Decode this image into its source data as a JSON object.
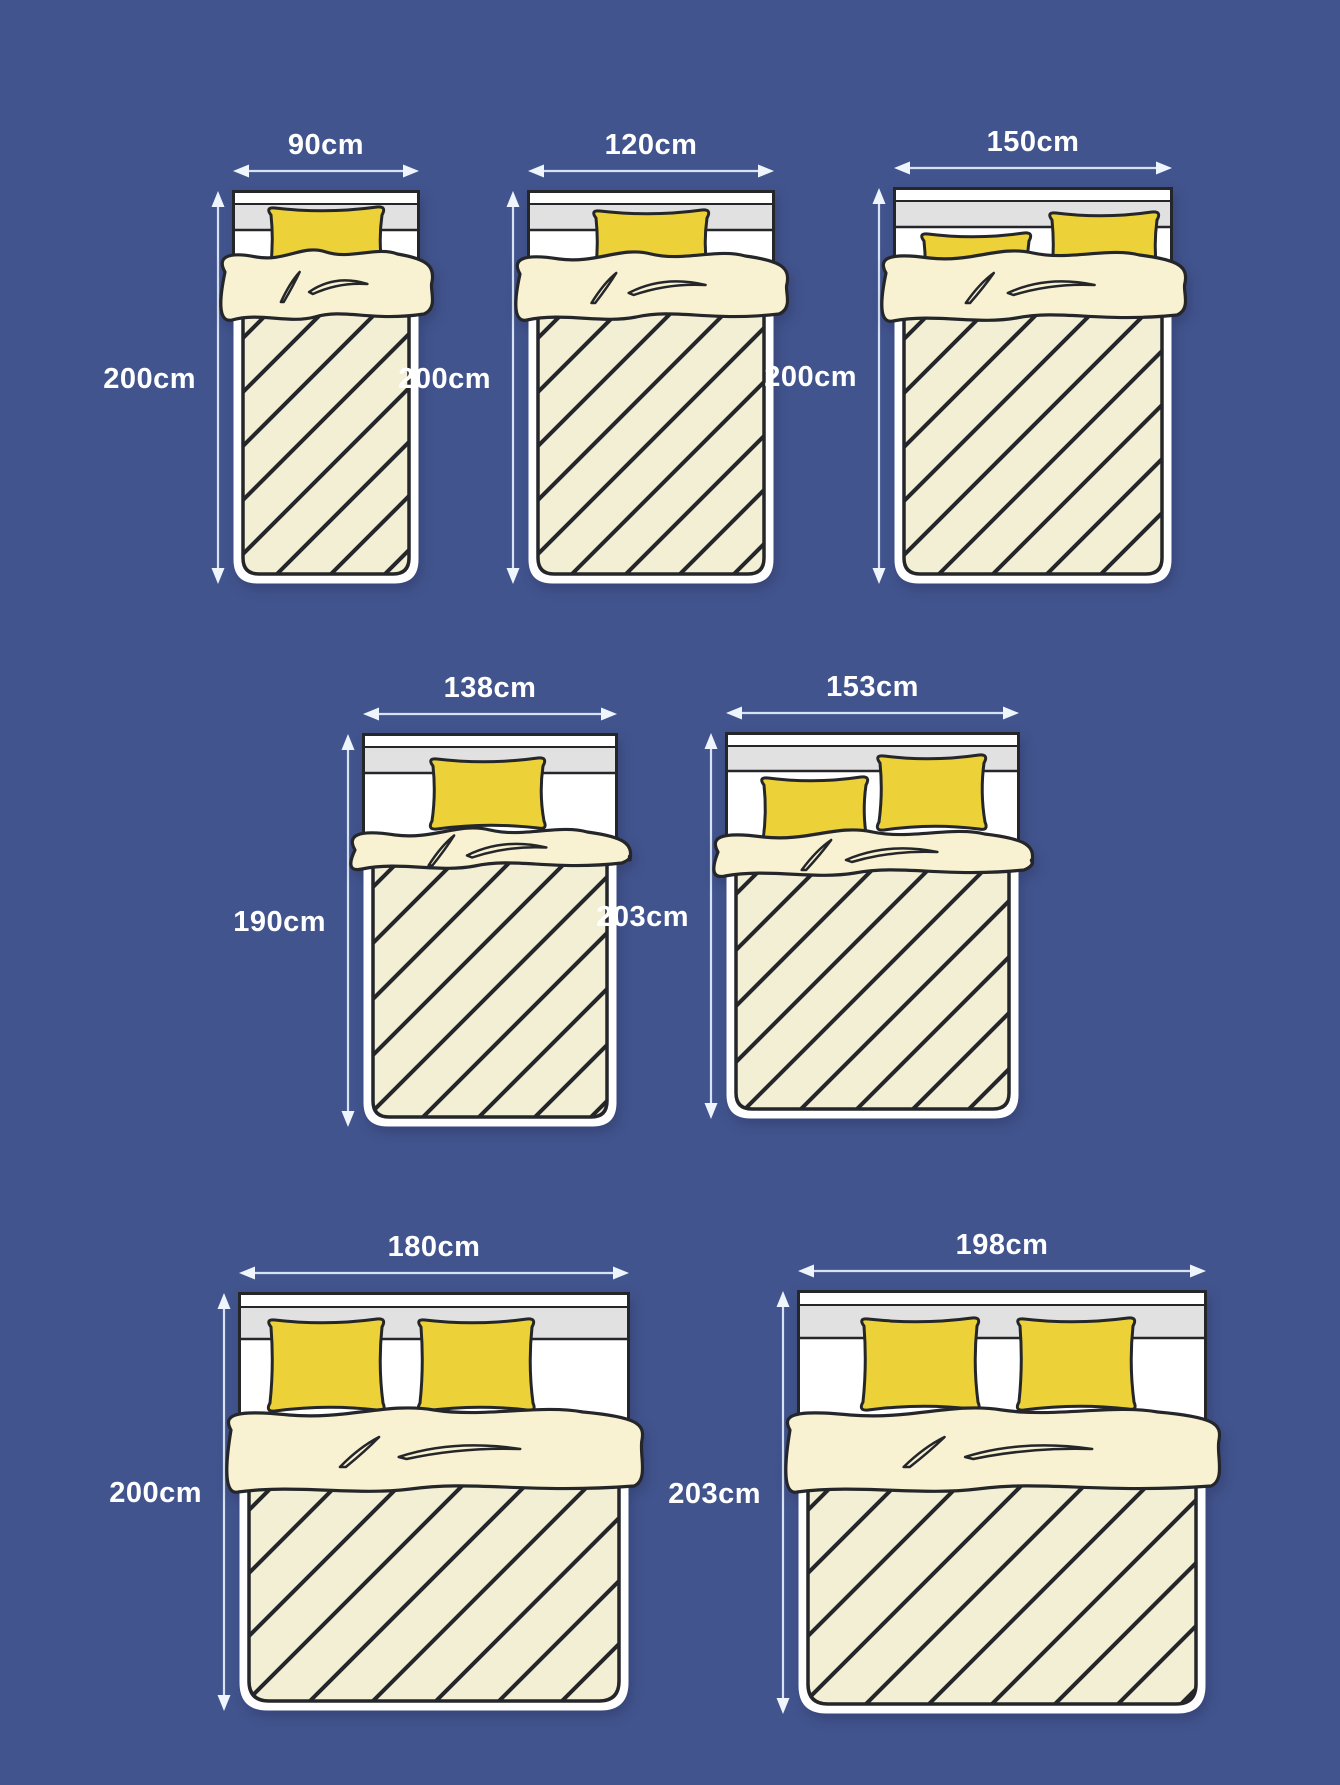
{
  "page": {
    "description": "Bed and mattress size comparison diagram",
    "unit": "cm"
  },
  "colors": {
    "background": "#42548e",
    "ink": "#24262a",
    "pillow": "#ecd138",
    "blanket": "#f8f2d2",
    "mattress": "#f3efd5",
    "headboard_gray": "#e1e1e1",
    "frame_white": "#ffffff",
    "arrow_line": "#d7e3f2",
    "arrow_head": "#eef5fc",
    "label_text": "#ffffff"
  },
  "rows": [
    {
      "beds": [
        {
          "width_label": "90cm",
          "height_label": "200cm",
          "width_cm": 90,
          "height_cm": 200,
          "pillows": 1
        },
        {
          "width_label": "120cm",
          "height_label": "200cm",
          "width_cm": 120,
          "height_cm": 200,
          "pillows": 1
        },
        {
          "width_label": "150cm",
          "height_label": "200cm",
          "width_cm": 150,
          "height_cm": 200,
          "pillows": 2
        }
      ]
    },
    {
      "beds": [
        {
          "width_label": "138cm",
          "height_label": "190cm",
          "width_cm": 138,
          "height_cm": 190,
          "pillows": 1
        },
        {
          "width_label": "153cm",
          "height_label": "203cm",
          "width_cm": 153,
          "height_cm": 203,
          "pillows": 2
        }
      ]
    },
    {
      "beds": [
        {
          "width_label": "180cm",
          "height_label": "200cm",
          "width_cm": 180,
          "height_cm": 200,
          "pillows": 2
        },
        {
          "width_label": "198cm",
          "height_label": "203cm",
          "width_cm": 198,
          "height_cm": 203,
          "pillows": 2
        }
      ]
    }
  ]
}
